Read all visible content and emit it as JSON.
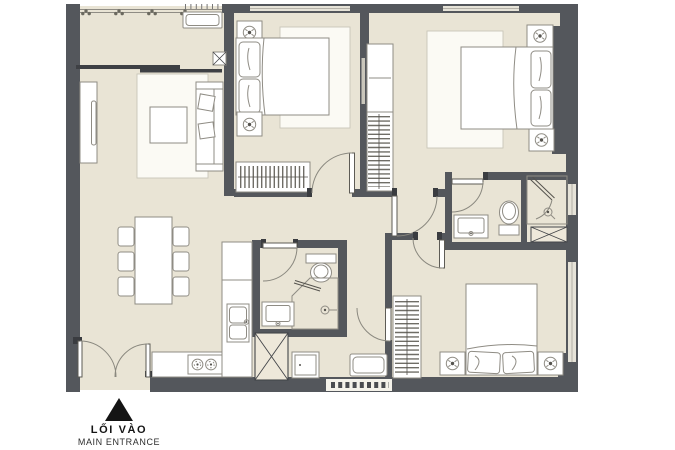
{
  "entrance_marker": {
    "icon": "up-triangle-icon",
    "label_primary": "LỐI VÀO",
    "label_secondary": "MAIN ENTRANCE"
  },
  "palette": {
    "wall": "#54575c",
    "floor": "#e9e4d5",
    "rug": "#fbfaf4",
    "outline": "#8f8c84",
    "window": "#e6e3d8",
    "background": "#ffffff",
    "marker": "#141414"
  },
  "rooms": [
    {
      "name": "balcony",
      "features": [
        "railing-with-plants",
        "ac-unit",
        "service-shaft",
        "sliding-door"
      ]
    },
    {
      "name": "living-room",
      "features": [
        "tv-console",
        "tv",
        "rug",
        "coffee-table",
        "sofa-with-cushions"
      ]
    },
    {
      "name": "dining-area",
      "features": [
        "dining-table",
        "six-chairs"
      ]
    },
    {
      "name": "kitchen",
      "features": [
        "l-shaped-counter",
        "double-sink",
        "two-burner-stove",
        "refrigerator",
        "service-shaft"
      ]
    },
    {
      "name": "bedroom-top-middle",
      "features": [
        "double-bed",
        "two-pillows",
        "two-nightstands-with-lamps",
        "rug",
        "hanger-wardrobe",
        "window"
      ]
    },
    {
      "name": "bedroom-top-right",
      "features": [
        "double-bed",
        "two-pillows",
        "two-nightstands-with-lamps",
        "rug",
        "hanger-wardrobe",
        "window"
      ]
    },
    {
      "name": "bedroom-bottom-right",
      "features": [
        "double-bed",
        "two-pillows",
        "two-nightstands-with-lamps",
        "hanger-wardrobe",
        "window"
      ]
    },
    {
      "name": "bathroom-ensuite",
      "features": [
        "sink",
        "toilet",
        "shower",
        "service-shaft",
        "window"
      ]
    },
    {
      "name": "bathroom-common",
      "features": [
        "sink",
        "toilet",
        "corner-shower"
      ]
    },
    {
      "name": "hallway",
      "features": [
        "swing-doors"
      ]
    },
    {
      "name": "entrance-foyer",
      "features": [
        "double-swing-door",
        "vent-grille",
        "ac-unit"
      ]
    }
  ]
}
